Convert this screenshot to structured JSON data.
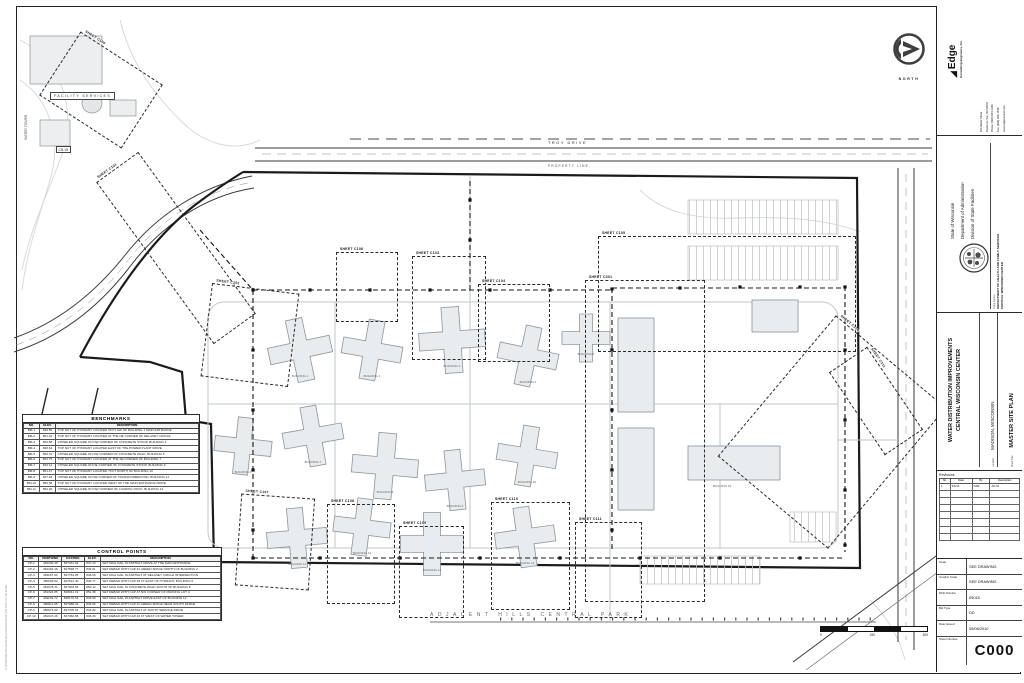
{
  "sheet": {
    "park_label": "ADJACENT  HILLS  CENTRAL  PARK",
    "file_stamp": "S:\\2009\\09015\\CAD\\SHEETS\\C000-MASTER SITE PLAN.DWG",
    "north_label": "NORTH"
  },
  "plan": {
    "facility_services_label": "FACILITY SERVICES",
    "cb_label": "CB-18",
    "water_tower_label": "WATER TOWER",
    "road_top_label": "TROY DRIVE",
    "property_line_label": "PROPERTY LINE",
    "scale_numbers": [
      "0",
      "150",
      "300"
    ]
  },
  "callouts": {
    "items": [
      "SHEET C100",
      "SHEET C101",
      "SHEET C102",
      "SHEET C103",
      "SHEET C104",
      "SHEET C105",
      "SHEET C106",
      "SHEET C107",
      "SHEET C108",
      "SHEET C109",
      "SHEET C110",
      "SHEET C111",
      "SHEET C301",
      "SHEET C310",
      "SHEET C311"
    ]
  },
  "buildings": {
    "labels": [
      "BUILDING 1",
      "BUILDING 2",
      "BUILDING 3",
      "BUILDING 4",
      "BUILDING 5",
      "BUILDING 6",
      "BUILDING 7",
      "BUILDING 8",
      "BUILDING 9",
      "BUILDING 10",
      "BUILDING 11",
      "BUILDING 12",
      "BUILDING 13",
      "BUILDING 14",
      "BUILDING 15"
    ]
  },
  "benchmarks": {
    "title": "BENCHMARKS",
    "headers": [
      "NO.",
      "ELEV.",
      "DESCRIPTION"
    ],
    "rows": [
      [
        "BM-1",
        "849.56",
        "TOP NUT OF HYDRANT LOCATED 50 FT SW OF BUILDING 1 MAIN ENTRANCE"
      ],
      [
        "BM-2",
        "851.02",
        "TOP NUT OF HYDRANT LOCATED AT THE NE CORNER OF DELANEY CIRCLE"
      ],
      [
        "BM-3",
        "852.88",
        "CHISELED SQUARE ON NW CORNER OF CONCRETE STOOP, BUILDING 3"
      ],
      [
        "BM-4",
        "848.64",
        "TOP NUT OF HYDRANT LOCATED EAST OF THE POWER PLANT DRIVE"
      ],
      [
        "BM-5",
        "850.31",
        "CHISELED SQUARE ON SW CORNER OF CONCRETE WALK, BUILDING 5"
      ],
      [
        "BM-6",
        "853.75",
        "TOP NUT OF HYDRANT LOCATED AT THE SE CORNER OF BUILDING 7"
      ],
      [
        "BM-7",
        "849.12",
        "CHISELED SQUARE ON NE CORNER OF CONCRETE STOOP, BUILDING 9"
      ],
      [
        "BM-8",
        "851.47",
        "TOP NUT OF HYDRANT LOCATED 75 FT NORTH OF BUILDING 10"
      ],
      [
        "BM-9",
        "847.93",
        "CHISELED SQUARE ON SE CORNER OF TRANSFORMER PAD, BUILDING 11"
      ],
      [
        "BM-10",
        "850.58",
        "TOP NUT OF HYDRANT LOCATED WEST OF THE MAIN ENTRANCE DRIVE"
      ],
      [
        "BM-11",
        "852.26",
        "CHISELED SQUARE ON NW CORNER OF LOADING DOCK, BUILDING 14"
      ]
    ]
  },
  "control_points": {
    "title": "CONTROL POINTS",
    "headers": [
      "NO.",
      "NORTHING",
      "EASTING",
      "ELEV.",
      "DESCRIPTION"
    ],
    "rows": [
      [
        "CP-1",
        "481236.48",
        "827431.02",
        "847.23",
        "SET MAG NAIL IN ASPHALT DRIVE AT THE MAIN ENTRANCE"
      ],
      [
        "CP-2",
        "481402.16",
        "827598.77",
        "849.61",
        "SET REBAR WITH CAP IN GREEN SPACE NORTH OF BUILDING 2"
      ],
      [
        "CP-3",
        "481187.93",
        "827764.25",
        "848.05",
        "SET MAG NAIL IN ASPHALT AT DELANEY CIRCLE INTERSECTION"
      ],
      [
        "CP-4",
        "480996.54",
        "827612.40",
        "846.77",
        "SET REBAR WITH CAP 25 FT EAST OF HYDRANT, BUILDING 6"
      ],
      [
        "CP-5",
        "481078.31",
        "827903.66",
        "850.12",
        "SET MAG NAIL IN CONCRETE WALK SOUTH OF BUILDING 8"
      ],
      [
        "CP-6",
        "481324.85",
        "828041.19",
        "851.38",
        "SET REBAR WITH CAP AT NW CORNER OF PARKING LOT C"
      ],
      [
        "CP-7",
        "481149.72",
        "828176.54",
        "849.90",
        "SET MAG NAIL IN ASPHALT DRIVE EAST OF BUILDING 12"
      ],
      [
        "CP-8",
        "480911.08",
        "827988.23",
        "845.66",
        "SET REBAR WITH CAP IN GREEN SPACE NEAR SOUTH FENCE"
      ],
      [
        "CP-9",
        "480874.60",
        "827705.91",
        "844.82",
        "SET MAG NAIL IN ASPHALT AT SOUTH SERVICE DRIVE"
      ],
      [
        "CP-10",
        "481047.26",
        "827366.88",
        "846.39",
        "SET REBAR WITH CAP 40 FT WEST OF WATER TOWER"
      ]
    ]
  },
  "titleblock": {
    "firm": {
      "name": "Edge",
      "tagline": "Consulting Engineers, Inc.",
      "address_lines": [
        "624 Water Street",
        "Prairie du Sac, WI 53578",
        "Phone: (608) 644-1449",
        "Fax: (608) 644-1549",
        "www.edgeconsult.com"
      ]
    },
    "state": {
      "line1": "State of Wisconsin",
      "line2": "Department of Administration",
      "line3": "Division of State Facilities",
      "agency_label": "Using Agency",
      "agency1": "DEPARTMENT OF HEALTH AND FAMILY SERVICES",
      "agency2": "CENTRAL WISCONSIN CENTER"
    },
    "project": {
      "title1": "WATER DISTRIBUTION IMPROVEMENTS",
      "title2": "CENTRAL WISCONSIN CENTER",
      "location_label": "Location:",
      "location": "MADISON, WISCONSIN",
      "sheet_title_label": "Sheet Title:",
      "sheet_title": "MASTER SITE PLAN"
    },
    "revisions": {
      "title": "Revisions",
      "headers": [
        "No.",
        "Date",
        "By",
        "Description"
      ],
      "rows": [
        [
          "1",
          "3/5/10",
          "DAB",
          "AD #1"
        ]
      ],
      "empty_rows": 7
    },
    "fields": [
      {
        "label": "Scale",
        "value": "SEE DRAWING"
      },
      {
        "label": "Graphic Scale",
        "value": "SEE DRAWING"
      },
      {
        "label": "DFD Number",
        "value": "09015"
      },
      {
        "label": "Bid Type",
        "value": "DD"
      },
      {
        "label": "Date Issued",
        "value": "05/06/2010"
      }
    ],
    "sheet_number_label": "Sheet Number",
    "sheet_number": "C000"
  }
}
